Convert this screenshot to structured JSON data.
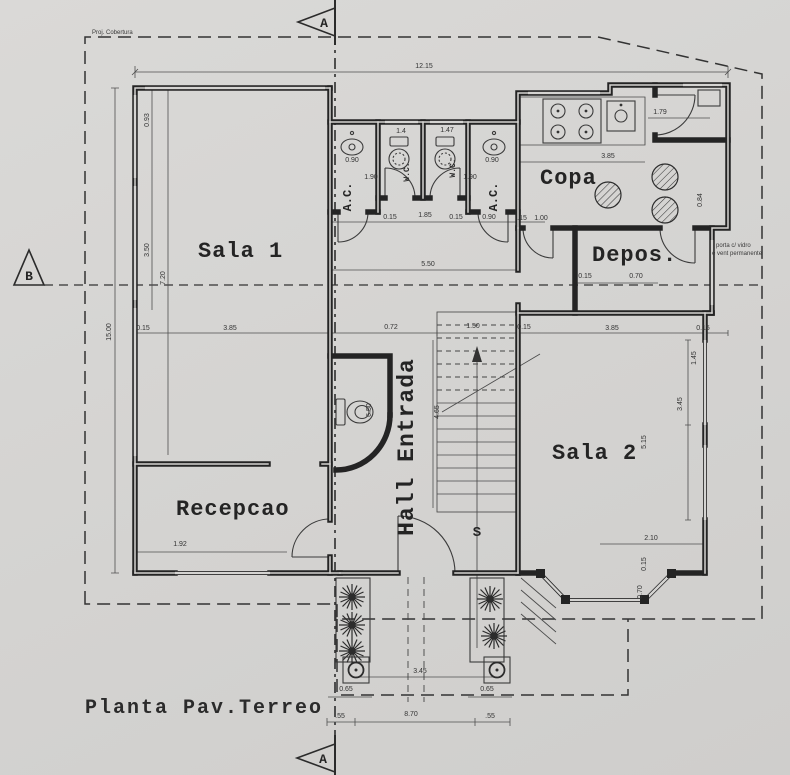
{
  "title": "Planta Pav.Terreo",
  "section_markers": {
    "top": "A",
    "bottom": "A",
    "left": "B"
  },
  "annotations": {
    "roof_projection": "Proj. Cobertura",
    "door_note_line1": "porta c/ vidro",
    "door_note_line2": "e vent permanente"
  },
  "rooms": {
    "sala1": "Sala 1",
    "sala2": "Sala 2",
    "recepcao": "Recepcao",
    "copa": "Copa",
    "deposito": "Depos.",
    "hall": "Hall Entrada",
    "wc1": "W.C.",
    "wc2": "W.C.",
    "ac1": "A.C.",
    "ac2": "A.C.",
    "stairs_up": "S"
  },
  "colors": {
    "paper": "#d5d4d2",
    "ink": "#2b2b2b",
    "wall": "#242424"
  },
  "dimensions": [
    {
      "t": "12.15",
      "x": 424,
      "y": 68
    },
    {
      "t": "15.00",
      "x": 111,
      "y": 332,
      "r": -90
    },
    {
      "t": "0.93",
      "x": 149,
      "y": 120,
      "r": -90
    },
    {
      "t": "3.50",
      "x": 149,
      "y": 250,
      "r": -90
    },
    {
      "t": "7.20",
      "x": 165,
      "y": 278,
      "r": -90
    },
    {
      "t": "0.15",
      "x": 143,
      "y": 330
    },
    {
      "t": "3.85",
      "x": 230,
      "y": 330
    },
    {
      "t": "0.72",
      "x": 391,
      "y": 329
    },
    {
      "t": "1.50",
      "x": 473,
      "y": 328
    },
    {
      "t": "0.15",
      "x": 524,
      "y": 329
    },
    {
      "t": "3.85",
      "x": 612,
      "y": 330
    },
    {
      "t": "0.15",
      "x": 703,
      "y": 330
    },
    {
      "t": "0.90",
      "x": 352,
      "y": 162
    },
    {
      "t": "1.90",
      "x": 371,
      "y": 179
    },
    {
      "t": "1.90",
      "x": 470,
      "y": 179
    },
    {
      "t": "0.90",
      "x": 492,
      "y": 162
    },
    {
      "t": "0.15",
      "x": 390,
      "y": 219
    },
    {
      "t": "1.85",
      "x": 425,
      "y": 217
    },
    {
      "t": "0.15",
      "x": 456,
      "y": 219
    },
    {
      "t": "0.90",
      "x": 489,
      "y": 219
    },
    {
      "t": ".15",
      "x": 522,
      "y": 220
    },
    {
      "t": "1.00",
      "x": 541,
      "y": 220
    },
    {
      "t": "1.4",
      "x": 401,
      "y": 133
    },
    {
      "t": "1.47",
      "x": 447,
      "y": 132
    },
    {
      "t": "5.50",
      "x": 428,
      "y": 266
    },
    {
      "t": "3.85",
      "x": 608,
      "y": 158
    },
    {
      "t": "1.79",
      "x": 660,
      "y": 114
    },
    {
      "t": "0.84",
      "x": 702,
      "y": 200,
      "r": -90
    },
    {
      "t": "0.15",
      "x": 585,
      "y": 278
    },
    {
      "t": "0.70",
      "x": 636,
      "y": 278
    },
    {
      "t": "1.45",
      "x": 696,
      "y": 358,
      "r": -90
    },
    {
      "t": "3.45",
      "x": 682,
      "y": 404,
      "r": -90
    },
    {
      "t": "5.15",
      "x": 646,
      "y": 442,
      "r": -90
    },
    {
      "t": "2.10",
      "x": 651,
      "y": 540
    },
    {
      "t": "0.15",
      "x": 646,
      "y": 564,
      "r": -90
    },
    {
      "t": "0.70",
      "x": 642,
      "y": 592,
      "r": -90
    },
    {
      "t": "6.50",
      "x": 371,
      "y": 410,
      "r": -90
    },
    {
      "t": "4.65",
      "x": 439,
      "y": 412,
      "r": -90
    },
    {
      "t": "1.92",
      "x": 180,
      "y": 546
    },
    {
      "t": "0.65",
      "x": 346,
      "y": 691
    },
    {
      "t": "0.65",
      "x": 487,
      "y": 691
    },
    {
      "t": "3.45",
      "x": 420,
      "y": 673
    },
    {
      "t": ".55",
      "x": 340,
      "y": 718
    },
    {
      "t": "8.70",
      "x": 411,
      "y": 716
    },
    {
      "t": ".55",
      "x": 490,
      "y": 718
    }
  ]
}
